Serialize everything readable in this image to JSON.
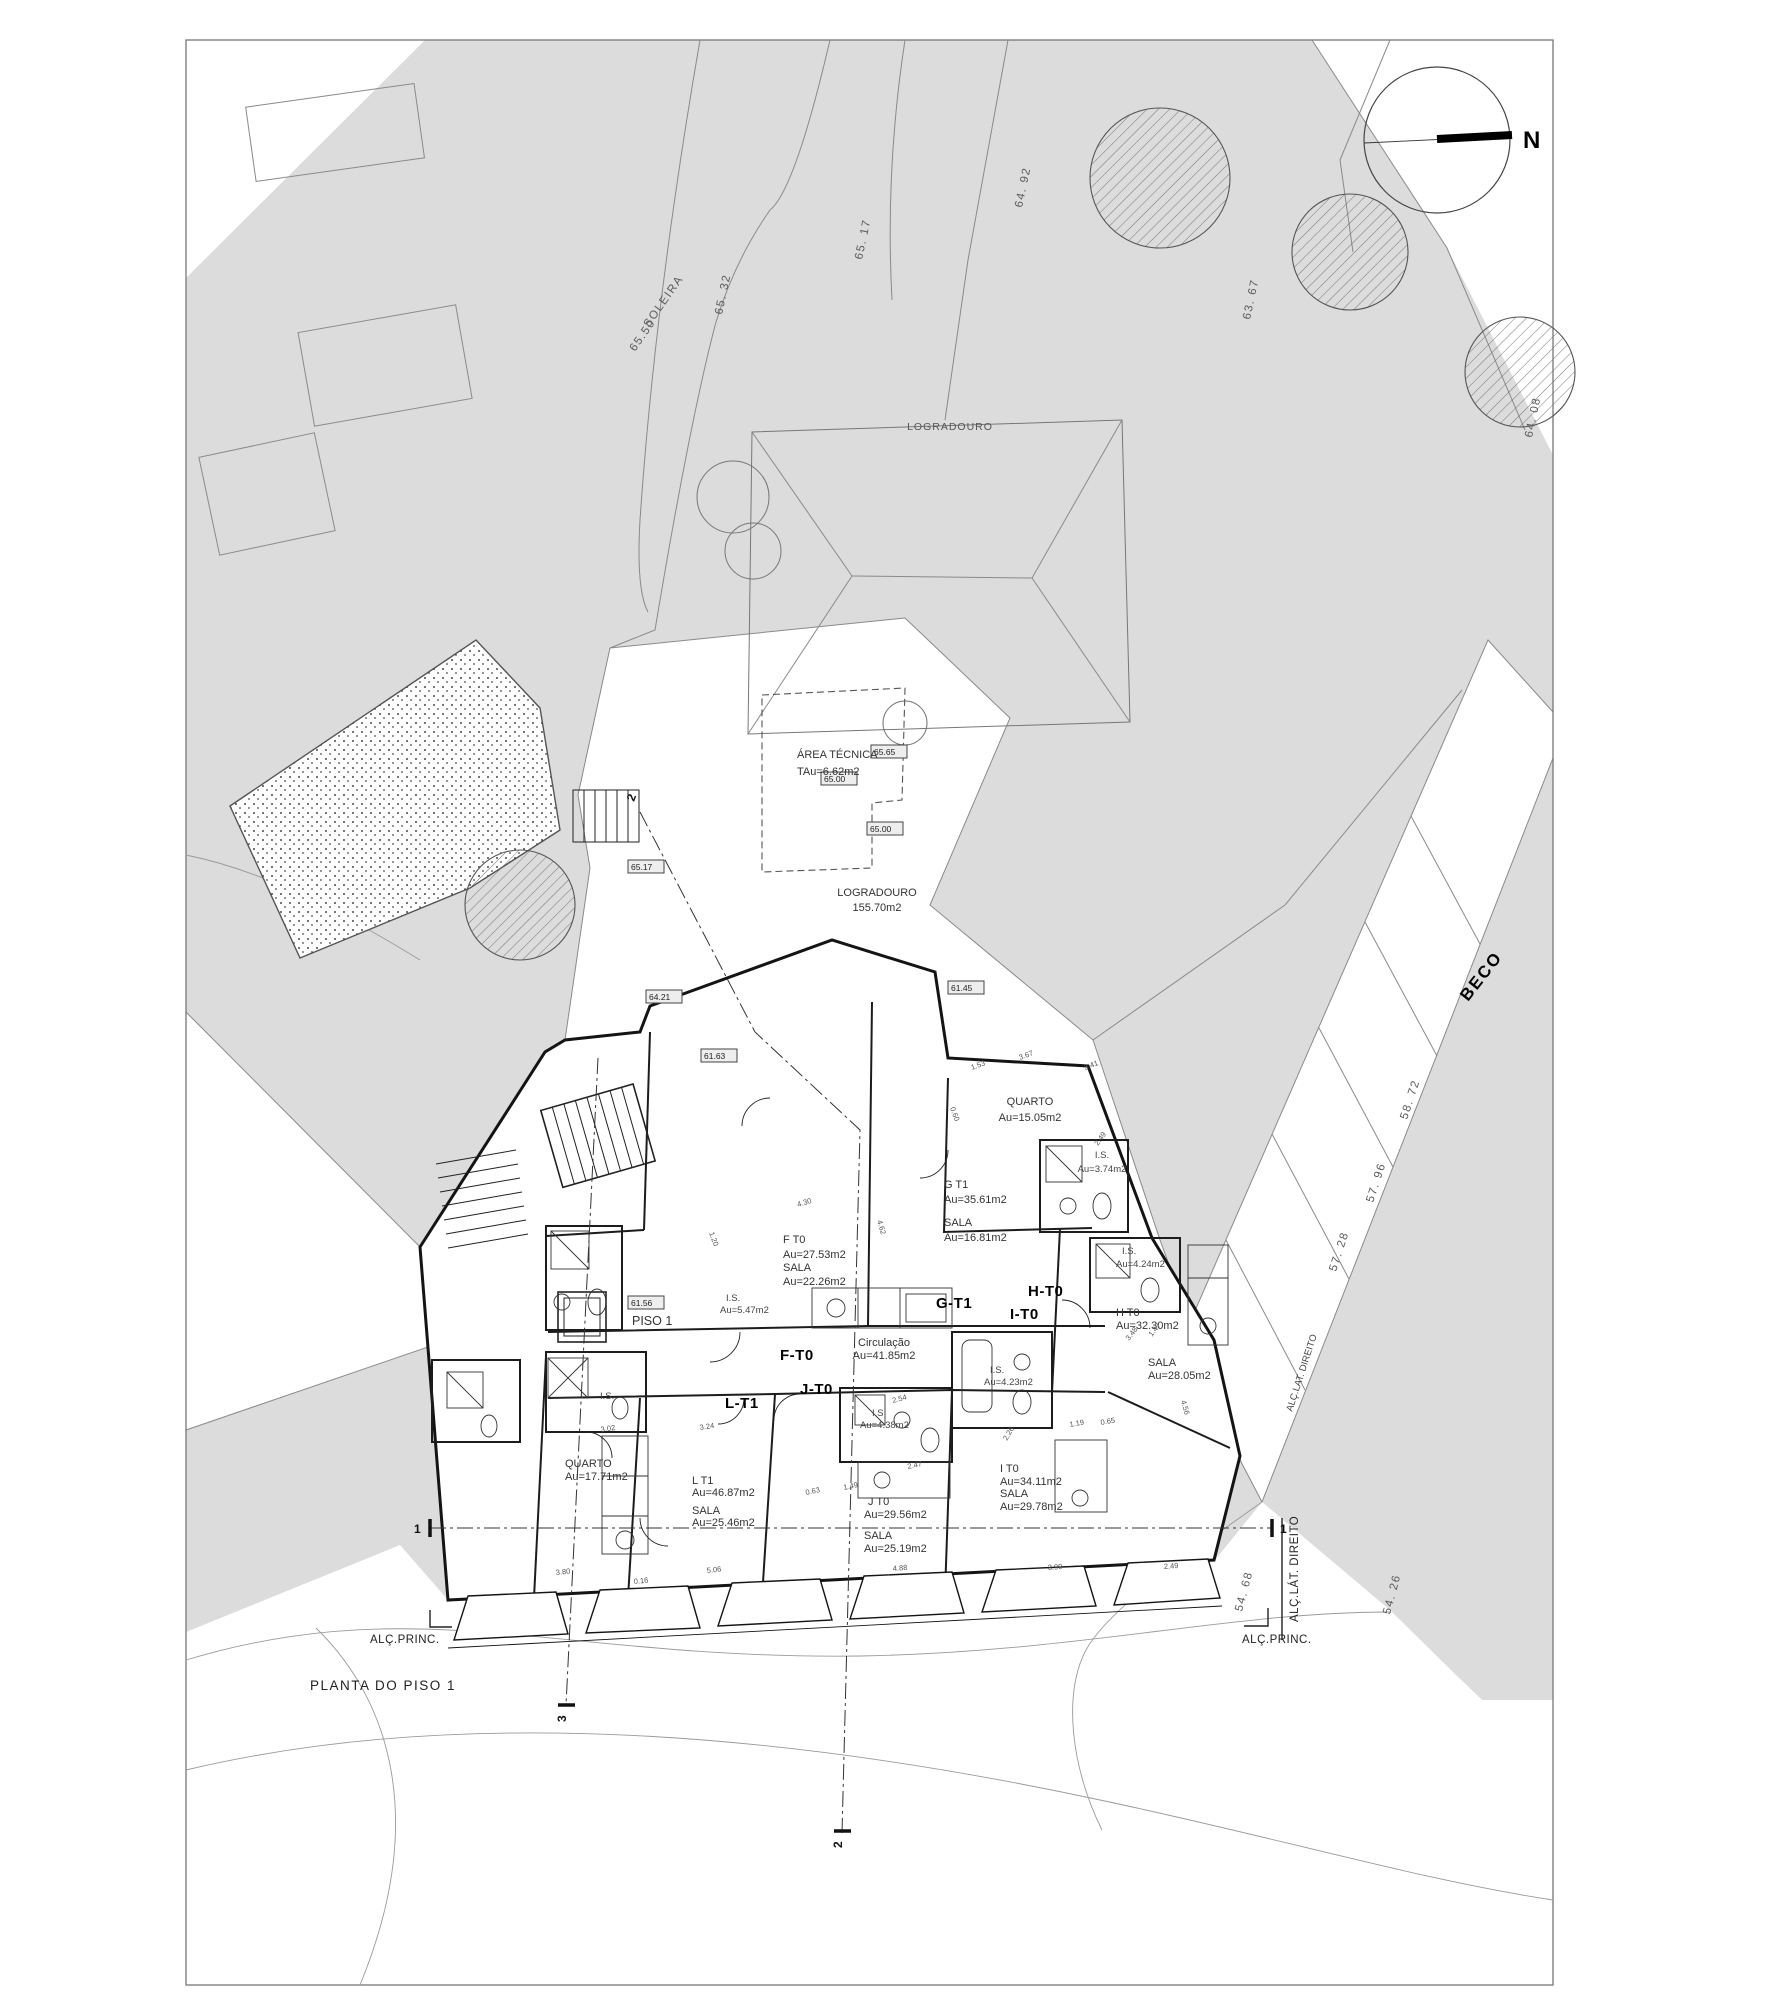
{
  "sheet": {
    "north_label": "N",
    "drawing_title": "PLANTA DO PISO 1"
  },
  "site": {
    "street": "BECO",
    "upper_yard": "LOGRADOURO",
    "yard_name": "LOGRADOURO",
    "yard_area": "155.70m2",
    "tech_area_name": "ÁREA TÉCNICA",
    "tech_area_value": "TAu=6.62m2",
    "floor_tag": "PISO 1",
    "soleira_label": "SOLEIRA",
    "soleira_value": "65.50"
  },
  "elevations": {
    "e1": "64. 92",
    "e2": "65. 17",
    "e3": "65. 32",
    "e4": "63. 67",
    "e5": "64. 08",
    "e6": "58. 72",
    "e7": "57. 96",
    "e8": "57. 28",
    "e9": "54. 68",
    "e10": "54. 26"
  },
  "level_chips": {
    "c1": "65.65",
    "c2": "65.00",
    "c3": "65.00",
    "c4": "65.17",
    "c5": "64.21",
    "c6": "61.63",
    "c7": "61.45",
    "c8": "61.56"
  },
  "units": {
    "f": "F-T0",
    "g": "G-T1",
    "h": "H-T0",
    "i": "I-T0",
    "j": "J-T0",
    "l": "L-T1"
  },
  "rooms": {
    "quarto_g": {
      "name": "QUARTO",
      "area": "Au=15.05m2"
    },
    "is_g": {
      "name": "I.S.",
      "area": "Au=3.74m2"
    },
    "g": {
      "name": "G T1",
      "area": "Au=35.61m2"
    },
    "sala_g": {
      "name": "SALA",
      "area": "Au=16.81m2"
    },
    "f": {
      "name": "F T0",
      "area": "Au=27.53m2"
    },
    "sala_f": {
      "name": "SALA",
      "area": "Au=22.26m2"
    },
    "is_f": {
      "name": "I.S.",
      "area": "Au=5.47m2"
    },
    "circ": {
      "name": "Circulação",
      "area": "Au=41.85m2"
    },
    "h": {
      "name": "H T0",
      "area": "Au=32.30m2"
    },
    "sala_h": {
      "name": "SALA",
      "area": "Au=28.05m2"
    },
    "is_h": {
      "name": "I.S.",
      "area": "Au=4.24m2"
    },
    "is_i": {
      "name": "I.S.",
      "area": "Au=4.23m2"
    },
    "is_j": {
      "name": "I.S.",
      "area": "Au=4.38m2"
    },
    "i": {
      "name": "I T0",
      "area": "Au=34.11m2"
    },
    "sala_i": {
      "name": "SALA",
      "area": "Au=29.78m2"
    },
    "j": {
      "name": "J T0",
      "area": "Au=29.56m2"
    },
    "sala_j": {
      "name": "SALA",
      "area": "Au=25.19m2"
    },
    "l": {
      "name": "L T1",
      "area": "Au=46.87m2"
    },
    "sala_l": {
      "name": "SALA",
      "area": "Au=25.46m2"
    },
    "quarto_l": {
      "name": "QUARTO",
      "area": "Au=17.71m2"
    },
    "is_small": {
      "name": "I.S."
    }
  },
  "annotations": {
    "alc_princ_left": "ALÇ.PRINC.",
    "alc_princ_right": "ALÇ.PRINC.",
    "alc_lat": "ALÇ.LÁT. DIREITO",
    "alc_lat2": "ALÇ.LAT. DIREITO"
  },
  "sections": {
    "s1l": "1",
    "s1r": "1",
    "s2t": "2",
    "s2b": "2",
    "s3b": "3"
  },
  "dims": [
    "1.53",
    "3.67",
    "3.41",
    "0.60",
    "2.49",
    "4.30",
    "1.20",
    "4.62",
    "3.02",
    "2.26",
    "1.19",
    "0.65",
    "2.54",
    "2.47",
    "1.49",
    "0.63",
    "3.80",
    "0.16",
    "5.06",
    "4.88",
    "3.99",
    "2.49",
    "3.24",
    "4.56",
    "3.48",
    "1.47"
  ],
  "colors": {
    "context_gray": "#dcdcdc",
    "wall_black": "#141414",
    "context_line": "#8a8a8a"
  }
}
